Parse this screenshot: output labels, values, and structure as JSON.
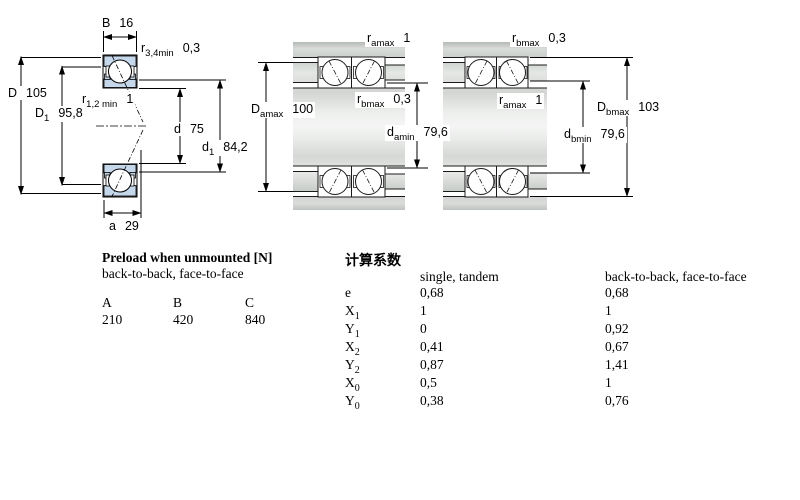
{
  "colors": {
    "ring_fill": "#c5d7ea",
    "metal_light": "#f2f3f2",
    "metal_dark": "#b9beb9",
    "line": "#000000"
  },
  "diagrams": {
    "single_bearing": {
      "labels": {
        "B": {
          "sym": "B",
          "sub": "",
          "val": "16"
        },
        "r34": {
          "sym": "r",
          "sub": "3,4min",
          "val": "0,3"
        },
        "D": {
          "sym": "D",
          "sub": "",
          "val": "105"
        },
        "D1": {
          "sym": "D",
          "sub": "1",
          "val": "95,8"
        },
        "r12": {
          "sym": "r",
          "sub": "1,2 min",
          "val": "1"
        },
        "d": {
          "sym": "d",
          "sub": "",
          "val": "75"
        },
        "d1": {
          "sym": "d",
          "sub": "1",
          "val": "84,2"
        },
        "a": {
          "sym": "a",
          "sub": "",
          "val": "29"
        }
      }
    },
    "pair_a": {
      "labels": {
        "ramax": {
          "sym": "r",
          "sub": "amax",
          "val": "1"
        },
        "Damax": {
          "sym": "D",
          "sub": "amax",
          "val": "100"
        },
        "rbmax": {
          "sym": "r",
          "sub": "bmax",
          "val": "0,3"
        },
        "damin": {
          "sym": "d",
          "sub": "amin",
          "val": "79,6"
        }
      }
    },
    "pair_b": {
      "labels": {
        "rbmax": {
          "sym": "r",
          "sub": "bmax",
          "val": "0,3"
        },
        "ramax": {
          "sym": "r",
          "sub": "amax",
          "val": "1"
        },
        "Dbmax": {
          "sym": "D",
          "sub": "bmax",
          "val": "103"
        },
        "dbmin": {
          "sym": "d",
          "sub": "bmin",
          "val": "79,6"
        }
      }
    }
  },
  "preload_table": {
    "title": "Preload when unmounted [N]",
    "subtitle": "back-to-back, face-to-face",
    "columns": [
      "A",
      "B",
      "C"
    ],
    "values": [
      "210",
      "420",
      "840"
    ]
  },
  "factors_table": {
    "title": "计算系数",
    "col1": "single, tandem",
    "col2": "back-to-back, face-to-face",
    "rows": [
      {
        "sym": "e",
        "sub": "",
        "single": "0,68",
        "paired": "0,68"
      },
      {
        "sym": "X",
        "sub": "1",
        "single": "1",
        "paired": "1"
      },
      {
        "sym": "Y",
        "sub": "1",
        "single": "0",
        "paired": "0,92"
      },
      {
        "sym": "X",
        "sub": "2",
        "single": "0,41",
        "paired": "0,67"
      },
      {
        "sym": "Y",
        "sub": "2",
        "single": "0,87",
        "paired": "1,41"
      },
      {
        "sym": "X",
        "sub": "0",
        "single": "0,5",
        "paired": "1"
      },
      {
        "sym": "Y",
        "sub": "0",
        "single": "0,38",
        "paired": "0,76"
      }
    ]
  }
}
